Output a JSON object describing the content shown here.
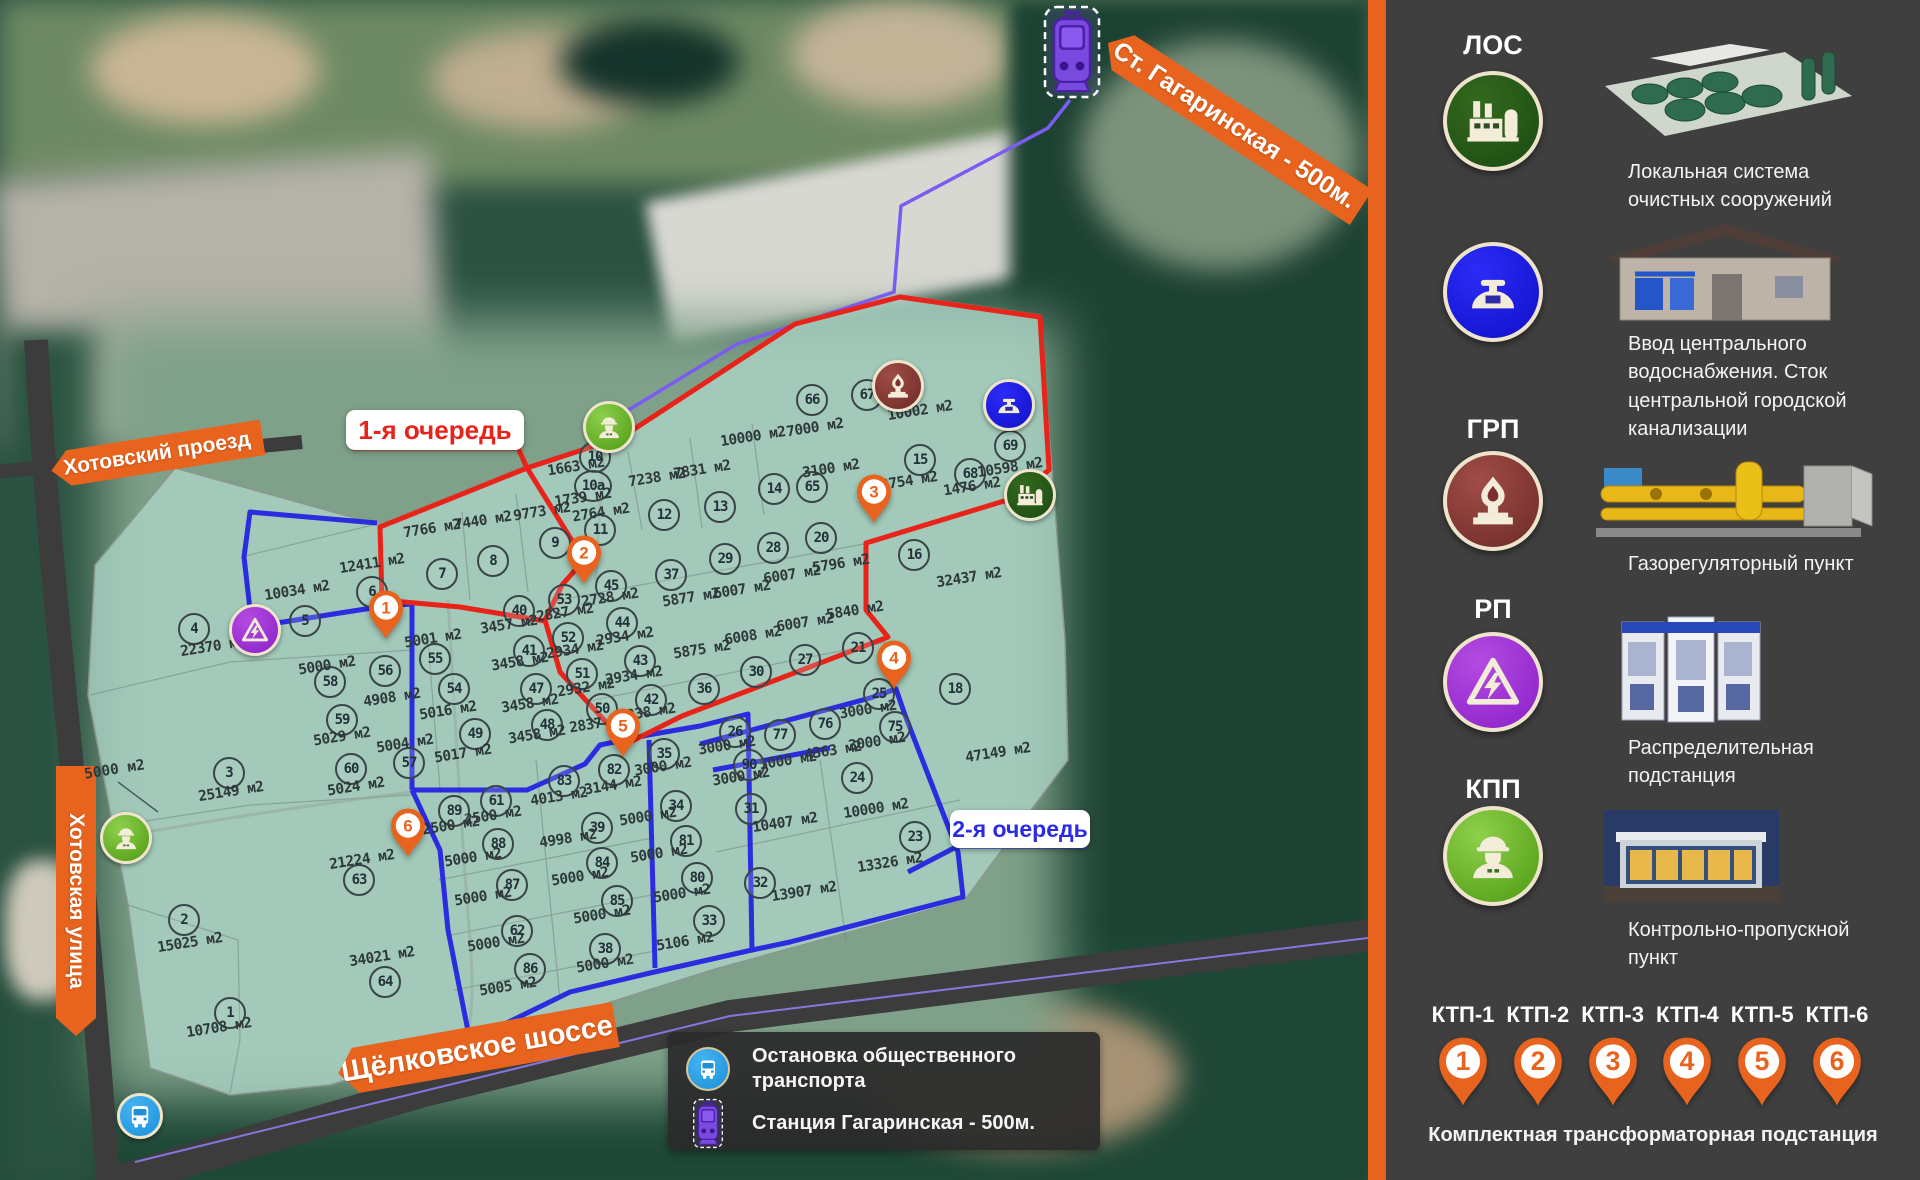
{
  "map": {
    "banners": {
      "station": "Ст. Гагаринская - 500м.",
      "road_proezd": "Хотовский проезд",
      "road_ulitsa": "Хотовская улица",
      "road_shosse": "Щёлковское шоссе"
    },
    "phase_labels": {
      "phase1": "1-я очередь",
      "phase2": "2-я очередь"
    },
    "legend": {
      "row1": "Остановка общественного транспорта",
      "row2": "Станция Гагаринская - 500м."
    },
    "free_label": "5000 м2",
    "plots": [
      [
        "1",
        "10708 м2",
        228,
        1011,
        219,
        1028
      ],
      [
        "2",
        "15025 м2",
        182,
        918,
        190,
        943
      ],
      [
        "3",
        "25149 м2",
        227,
        771,
        231,
        792
      ],
      [
        "4",
        "22370 м2",
        192,
        627,
        213,
        647
      ],
      [
        "5",
        "10034 м2",
        303,
        619,
        297,
        591
      ],
      [
        "6",
        "12411 м2",
        370,
        590,
        372,
        564
      ],
      [
        "7",
        "7766 м2",
        440,
        572,
        432,
        529
      ],
      [
        "8",
        "7440 м2",
        491,
        559,
        483,
        521
      ],
      [
        "9",
        "9773 м2",
        553,
        541,
        542,
        512
      ],
      [
        "10",
        "1663 м2",
        593,
        455,
        576,
        467
      ],
      [
        "10a",
        "1739 м2",
        591,
        484,
        583,
        498
      ],
      [
        "11",
        "2764 м2",
        598,
        528,
        601,
        513
      ],
      [
        "12",
        "7238 м2",
        662,
        513,
        657,
        478
      ],
      [
        "13",
        "7831 м2",
        718,
        505,
        702,
        470
      ],
      [
        "14",
        "10000 м2",
        772,
        487,
        753,
        437
      ],
      [
        "15",
        "12754 м2",
        918,
        458,
        905,
        482
      ],
      [
        "16",
        "32437 м2",
        912,
        553,
        969,
        578
      ],
      [
        "18",
        "47149 м2",
        953,
        687,
        998,
        753
      ],
      [
        "20",
        "5796 м2",
        819,
        536,
        841,
        564
      ],
      [
        "21",
        "5840 м2",
        856,
        646,
        855,
        611
      ],
      [
        "23",
        "13326 м2",
        913,
        835,
        890,
        863
      ],
      [
        "24",
        "10000 м2",
        855,
        776,
        876,
        809
      ],
      [
        "25",
        "3000 м2",
        877,
        692,
        868,
        710
      ],
      [
        "26",
        "3000 м2",
        733,
        730,
        727,
        746
      ],
      [
        "27",
        "6007 м2",
        803,
        658,
        805,
        623
      ],
      [
        "28",
        "6007 м2",
        771,
        546,
        792,
        575
      ],
      [
        "29",
        "6007 м2",
        723,
        557,
        742,
        590
      ],
      [
        "30",
        "6008 м2",
        754,
        670,
        753,
        636
      ],
      [
        "31",
        "10407 м2",
        749,
        807,
        785,
        823
      ],
      [
        "32",
        "13907 м2",
        758,
        881,
        804,
        892
      ],
      [
        "33",
        "5106 м2",
        707,
        919,
        685,
        942
      ],
      [
        "34",
        "5000 м2",
        674,
        804,
        648,
        817
      ],
      [
        "35",
        "3000 м2",
        662,
        752,
        663,
        767
      ],
      [
        "36",
        "5875 м2",
        702,
        687,
        702,
        650
      ],
      [
        "37",
        "5877 м2",
        669,
        573,
        691,
        598
      ],
      [
        "38",
        "5000 м2",
        603,
        947,
        605,
        964
      ],
      [
        "39",
        "4998 м2",
        595,
        826,
        568,
        839
      ],
      [
        "40",
        "3457 м2",
        517,
        609,
        509,
        625
      ],
      [
        "41",
        "3458 м2",
        527,
        649,
        520,
        662
      ],
      [
        "42",
        "2838 м2",
        649,
        698,
        647,
        713
      ],
      [
        "43",
        "2934 м2",
        638,
        659,
        634,
        676
      ],
      [
        "44",
        "2934 м2",
        620,
        621,
        625,
        637
      ],
      [
        "45",
        "2728 м2",
        609,
        584,
        610,
        598
      ],
      [
        "47",
        "3458 м2",
        534,
        687,
        530,
        704
      ],
      [
        "48",
        "3458 м2",
        545,
        723,
        537,
        735
      ],
      [
        "49",
        "5017 м2",
        473,
        732,
        463,
        754
      ],
      [
        "50",
        "2837 м2",
        600,
        707,
        598,
        724
      ],
      [
        "51",
        "2932 м2",
        580,
        672,
        586,
        688
      ],
      [
        "52",
        "2934 м2",
        566,
        636,
        575,
        650
      ],
      [
        "53",
        "2827 м2",
        562,
        598,
        565,
        613
      ],
      [
        "54",
        "5016 м2",
        452,
        687,
        448,
        711
      ],
      [
        "55",
        "5001 м2",
        433,
        657,
        433,
        639
      ],
      [
        "56",
        "4908 м2",
        383,
        669,
        392,
        698
      ],
      [
        "57",
        "5004 м2",
        407,
        761,
        405,
        744
      ],
      [
        "58",
        "5000 м2",
        328,
        680,
        327,
        666
      ],
      [
        "59",
        "5029 м2",
        340,
        718,
        342,
        737
      ],
      [
        "60",
        "5024 м2",
        349,
        767,
        356,
        787
      ],
      [
        "61",
        "2500 м2",
        494,
        799,
        493,
        816
      ],
      [
        "62",
        "5000 м2",
        515,
        929,
        496,
        943
      ],
      [
        "63",
        "21224 м2",
        357,
        878,
        362,
        860
      ],
      [
        "64",
        "34021 м2",
        383,
        980,
        382,
        957
      ],
      [
        "65",
        "3100 м2",
        810,
        485,
        831,
        469
      ],
      [
        "66",
        "7000 м2",
        810,
        398,
        815,
        428
      ],
      [
        "67",
        "10002 м2",
        865,
        393,
        920,
        411
      ],
      [
        "68",
        "1476 м2",
        968,
        472,
        972,
        487
      ],
      [
        "69",
        "10598 м2",
        1008,
        444,
        1010,
        468
      ],
      [
        "75",
        "3000 м2",
        893,
        725,
        877,
        742
      ],
      [
        "76",
        "4363 м2",
        823,
        722,
        833,
        751
      ],
      [
        "77",
        "5000 м2",
        778,
        733,
        788,
        761
      ],
      [
        "80",
        "5000 м2",
        695,
        876,
        682,
        894
      ],
      [
        "81",
        "5000 м2",
        684,
        839,
        659,
        854
      ],
      [
        "82",
        "3144 м2",
        612,
        768,
        613,
        786
      ],
      [
        "83",
        "4013 м2",
        562,
        779,
        559,
        797
      ],
      [
        "84",
        "5000 м2",
        600,
        861,
        580,
        877
      ],
      [
        "85",
        "5000 м2",
        615,
        899,
        602,
        915
      ],
      [
        "86",
        "5005 м2",
        528,
        967,
        508,
        987
      ],
      [
        "87",
        "5000 м2",
        510,
        883,
        483,
        897
      ],
      [
        "88",
        "5000 м2",
        496,
        842,
        473,
        858
      ],
      [
        "89",
        "2500 м2",
        452,
        809,
        451,
        826
      ],
      [
        "90",
        "3000 м2",
        747,
        763,
        741,
        777
      ]
    ],
    "pins": [
      [
        "1",
        386,
        640
      ],
      [
        "2",
        584,
        585
      ],
      [
        "3",
        874,
        524
      ],
      [
        "4",
        894,
        690
      ],
      [
        "5",
        623,
        758
      ],
      [
        "6",
        408,
        858
      ]
    ],
    "markers": [
      [
        "kpp",
        606,
        424
      ],
      [
        "grp",
        895,
        383
      ],
      [
        "water",
        1006,
        402
      ],
      [
        "los",
        1027,
        492
      ],
      [
        "rp",
        252,
        627
      ],
      [
        "kpp",
        123,
        835
      ],
      [
        "bus",
        137,
        1113
      ]
    ]
  },
  "sidebar": {
    "sections": [
      {
        "id": "los",
        "title": "ЛОС",
        "caption": "Локальная система очистных сооружений",
        "icon": "factory-icon"
      },
      {
        "id": "water",
        "title": "",
        "caption": "Ввод центрального водоснабжения. Сток центральной городской канализации",
        "icon": "valve-icon"
      },
      {
        "id": "grp",
        "title": "ГРП",
        "caption": "Газорегуляторный пункт",
        "icon": "gas-flame-icon"
      },
      {
        "id": "rp",
        "title": "РП",
        "caption": "Распределительная подстанция",
        "icon": "high-voltage-icon"
      },
      {
        "id": "kpp",
        "title": "КПП",
        "caption": "Контрольно-пропускной пункт",
        "icon": "worker-icon"
      }
    ],
    "ktp": {
      "labels": [
        "КТП-1",
        "КТП-2",
        "КТП-3",
        "КТП-4",
        "КТП-5",
        "КТП-6"
      ],
      "pins": [
        "1",
        "2",
        "3",
        "4",
        "5",
        "6"
      ],
      "caption": "Комплектная трансформаторная подстанция"
    }
  },
  "colors": {
    "accent_orange": "#e8641e",
    "phase1_red": "#e8231a",
    "phase2_blue": "#2b2be0",
    "route_purple": "#7b5cf0",
    "sidebar_bg": "#403f3f",
    "park_fill": "#abd3c6",
    "cream_border": "#ede4cb",
    "los_green": "#1b4a12",
    "water_blue": "#1717e0",
    "grp_maroon": "#7c2f2c",
    "rp_purple": "#8a1fc8",
    "kpp_green": "#4e9a12"
  }
}
